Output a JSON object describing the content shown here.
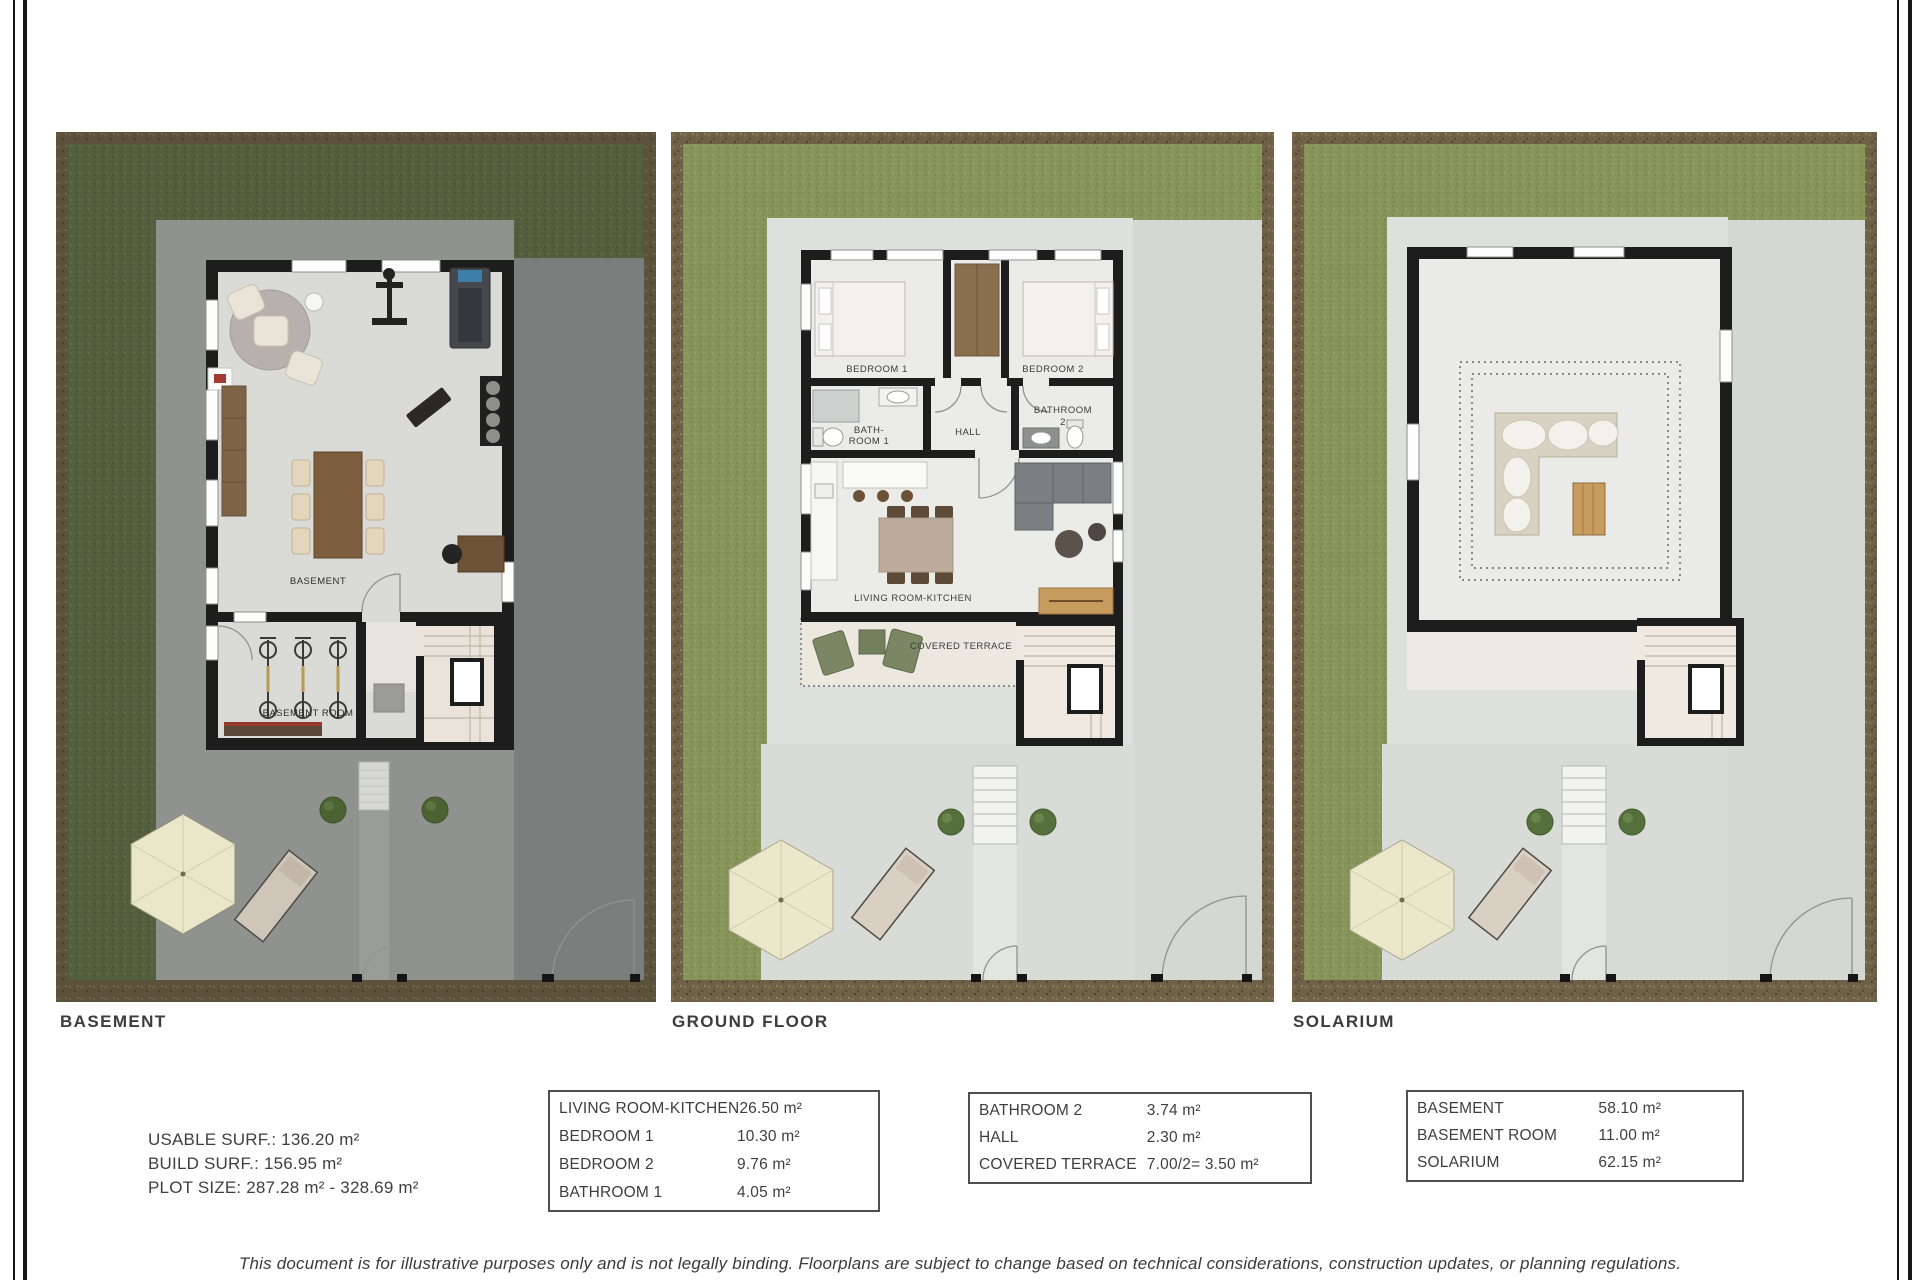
{
  "document": {
    "disclaimer": "This document is for illustrative purposes only and is not legally binding. Floorplans are subject to change based on technical considerations, construction updates, or planning regulations."
  },
  "plans": {
    "basement": {
      "caption": "BASEMENT",
      "rooms": {
        "main": "BASEMENT",
        "storage": "BASEMENT ROOM"
      }
    },
    "ground_floor": {
      "caption": "GROUND FLOOR",
      "rooms": {
        "bedroom1": "BEDROOM 1",
        "bedroom2": "BEDROOM 2",
        "bathroom1_line1": "BATH-",
        "bathroom1_line2": "ROOM 1",
        "hall": "HALL",
        "bathroom2_line1": "BATHROOM",
        "bathroom2_line2": "2",
        "living": "LIVING ROOM-KITCHEN",
        "terrace": "COVERED TERRACE"
      }
    },
    "solarium": {
      "caption": "SOLARIUM"
    }
  },
  "summary": {
    "usable_surface": "USABLE SURF.: 136.20 m²",
    "build_surface": "BUILD SURF.: 156.95 m²",
    "plot_size": "PLOT SIZE: 287.28 m² - 328.69 m²"
  },
  "area_tables": [
    {
      "rows": [
        {
          "label": "LIVING ROOM-KITCHEN",
          "value": "26.50 m²"
        },
        {
          "label": "BEDROOM 1",
          "value": "10.30 m²"
        },
        {
          "label": "BEDROOM 2",
          "value": "9.76 m²"
        },
        {
          "label": "BATHROOM 1",
          "value": "4.05 m²"
        }
      ]
    },
    {
      "rows": [
        {
          "label": "BATHROOM 2",
          "value": "3.74 m²"
        },
        {
          "label": "HALL",
          "value": "2.30 m²"
        },
        {
          "label": "COVERED TERRACE",
          "value": "7.00/2= 3.50 m²"
        }
      ]
    },
    {
      "rows": [
        {
          "label": "BASEMENT",
          "value": "58.10 m²"
        },
        {
          "label": "BASEMENT ROOM",
          "value": "11.00 m²"
        },
        {
          "label": "SOLARIUM",
          "value": "62.15 m²"
        }
      ]
    }
  ],
  "colors": {
    "garden_green": "#87955a",
    "garden_green_dark": "#545f3e",
    "soil_border": "#6f6148",
    "soil_border_dark": "#5c523c",
    "wall_black": "#1d1d1d",
    "paving_light": "#dde0dc",
    "paving_basement": "#90928f",
    "text": "#3e3e3e"
  }
}
